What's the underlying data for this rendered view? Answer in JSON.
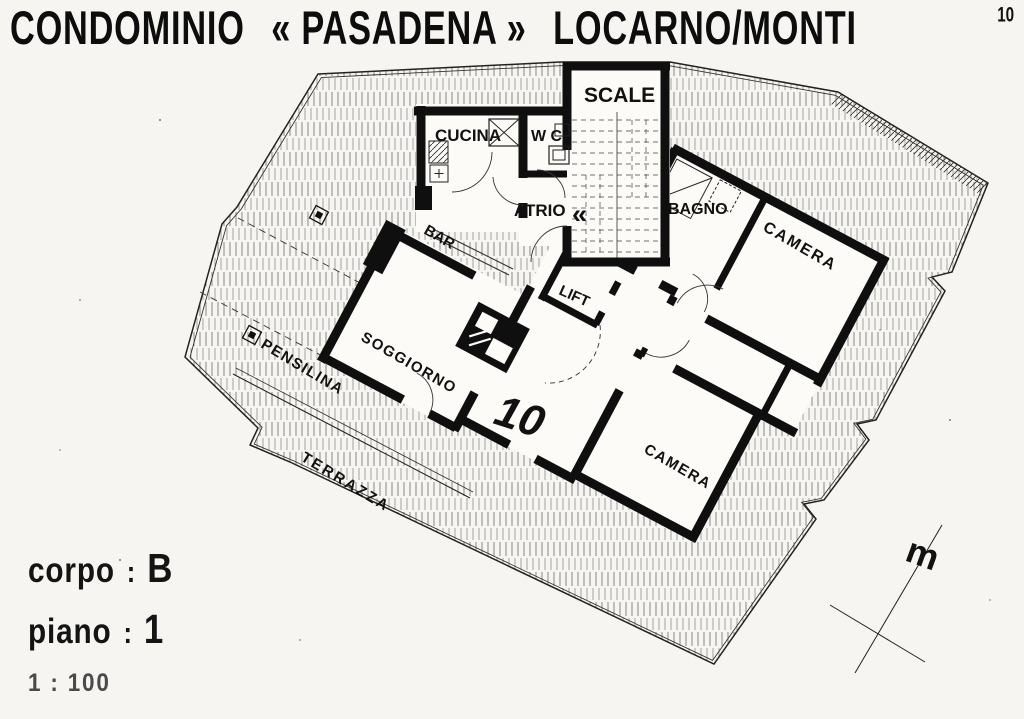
{
  "title": {
    "part1": "CONDOMINIO",
    "part2": "« PASADENA »",
    "part3": "LOCARNO/MONTI",
    "page_number": "10"
  },
  "plan": {
    "apartment_number": "10",
    "rooms": {
      "scale": "SCALE",
      "cucina": "CUCINA",
      "wc": "W C",
      "atrio": "ATRIO",
      "bagno": "BAGNO",
      "camera_ne": "CAMERA",
      "lift": "LIFT",
      "bar": "BAR",
      "soggiorno": "SOGGIORNO",
      "camera_se": "CAMERA",
      "pensilina": "PENSILINA",
      "terrazza": "TERRAZZA"
    },
    "door_symbol": "«",
    "north_marker": "m"
  },
  "legend": {
    "corpo_label": "corpo",
    "corpo_colon": ":",
    "corpo_value": "B",
    "piano_label": "piano",
    "piano_colon": ":",
    "piano_value": "1",
    "scale_text": "1 : 100"
  },
  "colors": {
    "ink": "#111111",
    "paper": "#f6f5f1",
    "hatch": "#555555"
  }
}
